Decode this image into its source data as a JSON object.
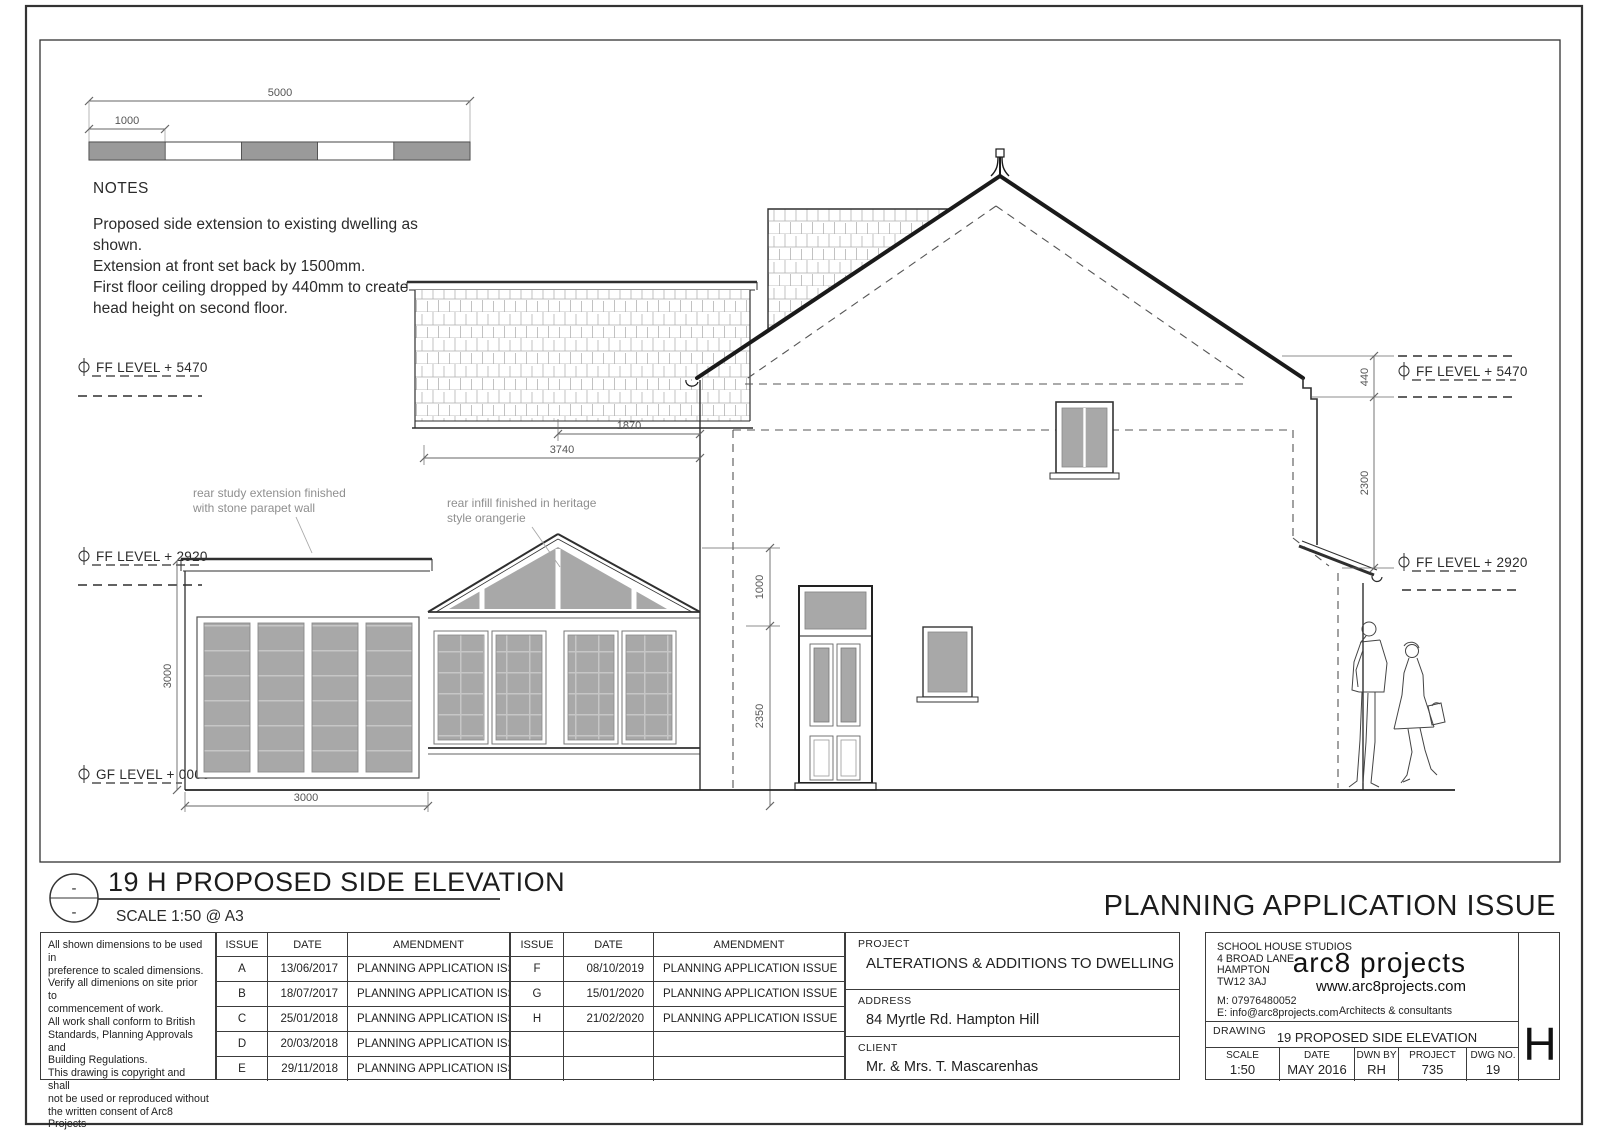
{
  "colors": {
    "glazing": "#a8a8a8",
    "scalebar_gray": "#9a9a9a",
    "line": "#2f2f2f",
    "annotation": "#8f8f8f"
  },
  "scale_bar": {
    "total": "5000",
    "first": "1000"
  },
  "notes_top": {
    "heading": "NOTES",
    "line1": "Proposed side extension to existing dwelling as",
    "line2": "shown.",
    "line3": "Extension at front set back by 1500mm.",
    "line4": "First floor ceiling dropped by 440mm to create",
    "line5": "head height on second floor."
  },
  "levels": {
    "ff5470": "FF LEVEL + 5470",
    "ff2920": "FF LEVEL + 2920",
    "gf": "GF LEVEL + 0000"
  },
  "dims": {
    "d1870": "1870",
    "d3740": "3740",
    "h3000": "3000",
    "w3000": "3000",
    "d1000": "1000",
    "d2350": "2350",
    "d440": "440",
    "d2300": "2300"
  },
  "ann": {
    "parapet1": "rear study extension finished",
    "parapet2": "with stone parapet wall",
    "orangerie1": "rear infill finished in heritage",
    "orangerie2": "style orangerie"
  },
  "title": {
    "ref_top": "-",
    "ref_bottom": "-",
    "name": "19 H PROPOSED SIDE ELEVATION",
    "scale": "SCALE 1:50 @ A3",
    "banner": "PLANNING APPLICATION ISSUE"
  },
  "general_notes": "All shown dimensions to be used in\npreference to scaled dimensions.\nVerify all dimenions on site prior to\ncommencement of work.\nAll work shall conform to British\nStandards, Planning Approvals and\nBuilding Regulations.\nThis drawing is copyright and shall\nnot be used or reproduced without\nthe written consent of Arc8 Projects\nLtd.",
  "revisions": {
    "headers": {
      "issue": "ISSUE",
      "date": "DATE",
      "amendment": "AMENDMENT"
    },
    "left": [
      {
        "issue": "A",
        "date": "13/06/2017",
        "amendment": "PLANNING APPLICATION ISSUE"
      },
      {
        "issue": "B",
        "date": "18/07/2017",
        "amendment": "PLANNING APPLICATION ISSUE"
      },
      {
        "issue": "C",
        "date": "25/01/2018",
        "amendment": "PLANNING APPLICATION ISSUE"
      },
      {
        "issue": "D",
        "date": "20/03/2018",
        "amendment": "PLANNING APPLICATION ISSUE"
      },
      {
        "issue": "E",
        "date": "29/11/2018",
        "amendment": "PLANNING APPLICATION ISSUE"
      }
    ],
    "right": [
      {
        "issue": "F",
        "date": "08/10/2019",
        "amendment": "PLANNING APPLICATION ISSUE"
      },
      {
        "issue": "G",
        "date": "15/01/2020",
        "amendment": "PLANNING APPLICATION ISSUE"
      },
      {
        "issue": "H",
        "date": "21/02/2020",
        "amendment": "PLANNING APPLICATION ISSUE"
      },
      {
        "issue": "",
        "date": "",
        "amendment": ""
      },
      {
        "issue": "",
        "date": "",
        "amendment": ""
      }
    ]
  },
  "project": {
    "label": "PROJECT",
    "name": "ALTERATIONS & ADDITIONS TO DWELLING",
    "address_label": "ADDRESS",
    "address": "84 Myrtle Rd. Hampton Hill",
    "client_label": "CLIENT",
    "client": "Mr. & Mrs. T. Mascarenhas"
  },
  "firm": {
    "address": "SCHOOL HOUSE STUDIOS\n4 BROAD LANE\nHAMPTON\nTW12 3AJ",
    "mobile": "M: 07976480052",
    "email": "E: info@arc8projects.com",
    "logo": "arc8 projects",
    "web": "www.arc8projects.com",
    "tagline": "Architects & consultants"
  },
  "info": {
    "drawing_label": "DRAWING",
    "drawing": "19 PROPOSED SIDE ELEVATION",
    "scale_label": "SCALE",
    "scale": "1:50",
    "date_label": "DATE",
    "date": "MAY 2016",
    "dwn_label": "DWN BY",
    "dwn": "RH",
    "project_label": "PROJECT",
    "project": "735",
    "dwg_label": "DWG NO.",
    "dwg": "19",
    "rev": "H"
  }
}
